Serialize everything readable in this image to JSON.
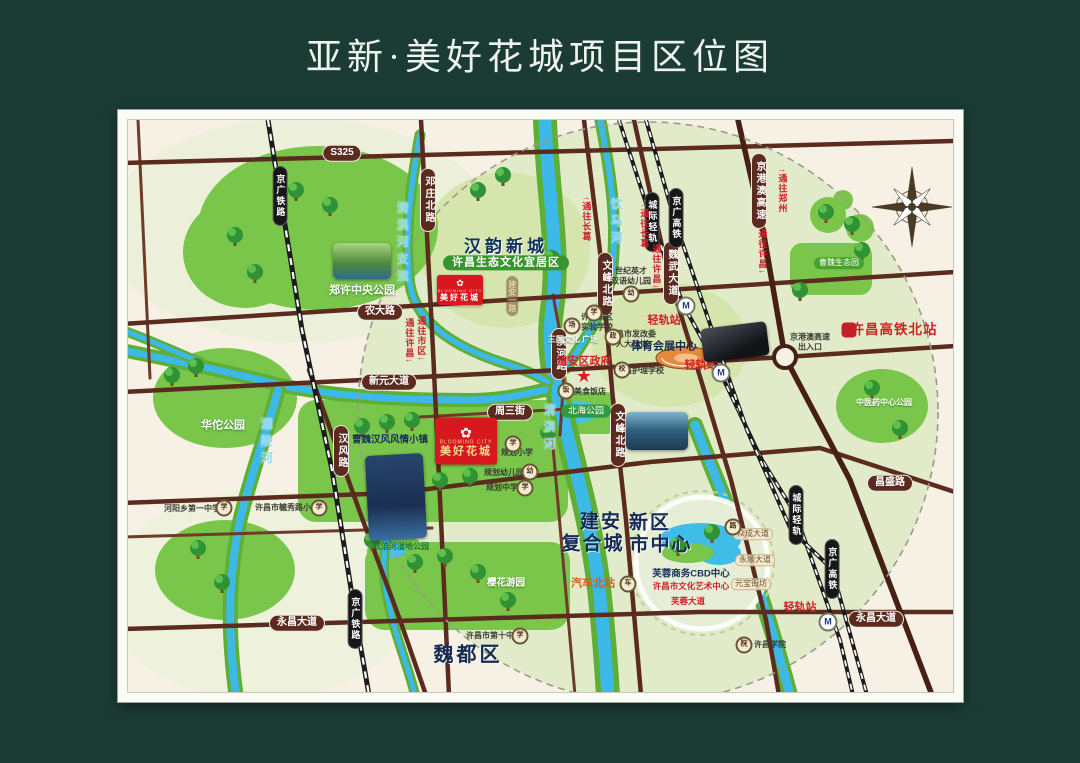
{
  "title": "亚新·美好花城项目区位图",
  "map": {
    "labels": [
      {
        "name": "road-badge-s325",
        "cls": "badge",
        "x": 342,
        "y": 153,
        "text": "S325"
      },
      {
        "name": "road-badge-nongdalu",
        "cls": "badge",
        "x": 380,
        "y": 312,
        "text": "农大路"
      },
      {
        "name": "road-badge-xinyuan-dadao",
        "cls": "badge",
        "x": 389,
        "y": 382,
        "text": "新元大道"
      },
      {
        "name": "road-badge-zhousanjie",
        "cls": "badge",
        "x": 510,
        "y": 412,
        "text": "周三街"
      },
      {
        "name": "road-badge-changsheng-w",
        "cls": "badge",
        "x": 394,
        "y": 494,
        "text": "昌盛路"
      },
      {
        "name": "road-badge-changsheng-e",
        "cls": "badge",
        "x": 890,
        "y": 483,
        "text": "昌盛路"
      },
      {
        "name": "road-badge-yongchang-w",
        "cls": "badge",
        "x": 297,
        "y": 623,
        "text": "永昌大道"
      },
      {
        "name": "road-badge-yongchang-e",
        "cls": "badge",
        "x": 876,
        "y": 619,
        "text": "永昌大道"
      },
      {
        "name": "road-badge-hanfenglu",
        "cls": "badge-v",
        "x": 341,
        "y": 451,
        "text": "汉风路"
      },
      {
        "name": "road-badge-dengzhuang-beilu",
        "cls": "badge-v",
        "x": 428,
        "y": 200,
        "text": "邓庄北路"
      },
      {
        "name": "road-badge-wenfeng-beilu-n",
        "cls": "badge-v",
        "x": 605,
        "y": 284,
        "text": "文峰北路"
      },
      {
        "name": "road-badge-wenfeng-beilu-s",
        "cls": "badge-v",
        "x": 618,
        "y": 435,
        "text": "文峰北路"
      },
      {
        "name": "road-badge-binhelu",
        "cls": "badge-v",
        "x": 559,
        "y": 354,
        "text": "滨河路"
      },
      {
        "name": "road-badge-weiwu-dadao",
        "cls": "badge-v",
        "x": 671,
        "y": 273,
        "text": "魏武大道"
      },
      {
        "name": "road-badge-jinggangao-gaosu",
        "cls": "badge-v",
        "x": 759,
        "y": 191,
        "text": "京港澳高速"
      },
      {
        "name": "road-label-jianan-yilu",
        "cls": "tan-v",
        "x": 512,
        "y": 296,
        "text": "建安一路"
      },
      {
        "name": "rail-badge-jingguang-tielu-n",
        "cls": "railbadge-v",
        "x": 280,
        "y": 196,
        "text": "京广铁路"
      },
      {
        "name": "rail-badge-jingguang-tielu-s",
        "cls": "railbadge-v",
        "x": 355,
        "y": 619,
        "text": "京广铁路"
      },
      {
        "name": "rail-badge-chengji-qinggui-n",
        "cls": "railbadge-v",
        "x": 652,
        "y": 222,
        "text": "城际轻轨"
      },
      {
        "name": "rail-badge-jingguang-gaotie-n",
        "cls": "railbadge-v",
        "x": 676,
        "y": 218,
        "text": "京广高铁"
      },
      {
        "name": "rail-badge-chengji-qinggui-s",
        "cls": "railbadge-v",
        "x": 796,
        "y": 515,
        "text": "城际轻轨"
      },
      {
        "name": "rail-badge-jingguang-gaotie-s",
        "cls": "railbadge-v",
        "x": 832,
        "y": 569,
        "text": "京广高铁"
      },
      {
        "name": "dir-label-changge-1",
        "cls": "red-v",
        "x": 586,
        "y": 219,
        "text": "↑通往长葛"
      },
      {
        "name": "dir-label-changge-2",
        "cls": "red-v",
        "x": 644,
        "y": 226,
        "text": "↑通往长葛"
      },
      {
        "name": "dir-label-xuchang-1",
        "cls": "red-v",
        "x": 656,
        "y": 267,
        "text": "通往许昌↓"
      },
      {
        "name": "dir-label-xuchang-2",
        "cls": "red-v",
        "x": 762,
        "y": 252,
        "text": "通往许昌↓"
      },
      {
        "name": "dir-label-zhengzhou",
        "cls": "red-v",
        "x": 782,
        "y": 191,
        "text": "↑通往郑州"
      },
      {
        "name": "dir-label-xuchang-3",
        "cls": "red-v",
        "x": 409,
        "y": 341,
        "text": "通往许昌↓"
      },
      {
        "name": "dir-label-shiqu",
        "cls": "red-v",
        "x": 421,
        "y": 339,
        "text": "通往市区↓"
      },
      {
        "name": "river-label-qingyihe-zhiliu",
        "cls": "cyan-v",
        "x": 402,
        "y": 244,
        "text": "清潩河支流"
      },
      {
        "name": "river-label-yinmahe",
        "cls": "cyan-v",
        "x": 616,
        "y": 223,
        "text": "饮马河"
      },
      {
        "name": "river-label-qingyihe",
        "cls": "cyan-v",
        "x": 549,
        "y": 429,
        "text": "清潩河"
      },
      {
        "name": "river-label-balinghe",
        "cls": "cyan-v",
        "x": 266,
        "y": 443,
        "text": "灞陵河"
      },
      {
        "name": "zone-title-hanyun-xincheng",
        "cls": "zone-title",
        "x": 506,
        "y": 247,
        "text": "汉韵新城"
      },
      {
        "name": "zone-pill-shengtai-wenhua",
        "cls": "zone-pill",
        "x": 506,
        "y": 263,
        "text": "许昌生态文化宜居区"
      },
      {
        "name": "park-label-zhengxu-central",
        "cls": "white-bold",
        "x": 362,
        "y": 291,
        "text": "郑许中央公园"
      },
      {
        "name": "park-label-huatuo",
        "cls": "white-bold",
        "x": 223,
        "y": 426,
        "text": "华佗公园"
      },
      {
        "name": "park-label-yinghua",
        "cls": "white-bold-sm",
        "x": 506,
        "y": 583,
        "text": "樱花游园"
      },
      {
        "name": "park-label-zhongyiyao",
        "cls": "white-xs",
        "x": 884,
        "y": 403,
        "text": "中医药中心公园"
      },
      {
        "name": "park-label-caowei-shengtaiyuan",
        "cls": "green-pill-sm",
        "x": 839,
        "y": 263,
        "text": "曹魏生态园"
      },
      {
        "name": "park-label-beihai",
        "cls": "green-pill",
        "x": 586,
        "y": 411,
        "text": "北海公园"
      },
      {
        "name": "park-label-shuangjihe-shidi",
        "cls": "green-xs",
        "x": 401,
        "y": 547,
        "text": "双洎河湿地公园"
      },
      {
        "name": "poi-label-town",
        "cls": "navy-sm-bold",
        "x": 390,
        "y": 440,
        "text": "曹魏汉风风情小镇"
      },
      {
        "name": "poi-label-planned-primary",
        "cls": "dark-xs",
        "x": 517,
        "y": 453,
        "text": "规划小学"
      },
      {
        "name": "poi-label-planned-kindergarten",
        "cls": "dark-xs",
        "x": 504,
        "y": 473,
        "text": "规划幼儿园"
      },
      {
        "name": "poi-label-planned-middle",
        "cls": "dark-xs",
        "x": 502,
        "y": 488,
        "text": "规划中学"
      },
      {
        "name": "poi-label-sanguo-square",
        "cls": "white-xs",
        "x": 573,
        "y": 340,
        "text": "三国文化\n广场"
      },
      {
        "name": "poi-label-jianan-gov",
        "cls": "red-bold",
        "x": 584,
        "y": 362,
        "text": "建安区政府"
      },
      {
        "name": "gov-star-icon",
        "cls": "star",
        "x": 584,
        "y": 376,
        "text": "★"
      },
      {
        "name": "poi-label-xinqu-school",
        "cls": "dark-xs",
        "x": 597,
        "y": 322,
        "text": "许昌新区\n实验学校"
      },
      {
        "name": "poi-label-fagaiwei",
        "cls": "dark-xs",
        "x": 632,
        "y": 339,
        "text": "许昌市发改委\n人大政协"
      },
      {
        "name": "poi-label-huli-school",
        "cls": "dark-xs",
        "x": 640,
        "y": 371,
        "text": "许昌护理学校"
      },
      {
        "name": "poi-label-restaurant",
        "cls": "dark-xs",
        "x": 582,
        "y": 392,
        "text": "东兴美食饭店"
      },
      {
        "name": "poi-label-sports-center",
        "cls": "navy-md",
        "x": 664,
        "y": 347,
        "text": "体育会展中心"
      },
      {
        "name": "station-label-qinggui-1",
        "cls": "red-bold",
        "x": 664,
        "y": 321,
        "text": "轻轨站"
      },
      {
        "name": "station-label-qinggui-2",
        "cls": "red-bold",
        "x": 701,
        "y": 366,
        "text": "轻轨站"
      },
      {
        "name": "station-label-qinggui-3",
        "cls": "red-bold",
        "x": 800,
        "y": 608,
        "text": "轻轨站"
      },
      {
        "name": "poi-label-highway-exit",
        "cls": "dark-xs",
        "x": 810,
        "y": 342,
        "text": "京港澳高速\n出入口"
      },
      {
        "name": "station-label-hsr-north",
        "cls": "red-bold-lg",
        "x": 894,
        "y": 330,
        "text": "许昌高铁北站"
      },
      {
        "name": "big-label-jianan",
        "cls": "navy-big",
        "x": 601,
        "y": 523,
        "text": "建安"
      },
      {
        "name": "big-label-xinqu",
        "cls": "navy-big",
        "x": 650,
        "y": 524,
        "text": "新区"
      },
      {
        "name": "big-label-fuhecheng",
        "cls": "navy-big",
        "x": 593,
        "y": 545,
        "text": "复合城"
      },
      {
        "name": "big-label-shizhongxin",
        "cls": "navy-big",
        "x": 661,
        "y": 546,
        "text": "市中心"
      },
      {
        "name": "big-label-weidou-district",
        "cls": "navy-big2",
        "x": 468,
        "y": 655,
        "text": "魏都区"
      },
      {
        "name": "poi-label-bus-north-station",
        "cls": "orange-bold",
        "x": 593,
        "y": 584,
        "text": "汽车北站"
      },
      {
        "name": "poi-label-furong-cbd",
        "cls": "navy-sm-bold",
        "x": 691,
        "y": 574,
        "text": "芙蓉商务CBD中心"
      },
      {
        "name": "poi-label-art-center",
        "cls": "red-xs",
        "x": 691,
        "y": 586,
        "text": "许昌市文化艺术中心"
      },
      {
        "name": "road-label-furong-dadao",
        "cls": "red-xs",
        "x": 688,
        "y": 601,
        "text": "芙蓉大道"
      },
      {
        "name": "road-label-zhongcheng-dadao",
        "cls": "tan-sm",
        "x": 753,
        "y": 534,
        "text": "众成大道"
      },
      {
        "name": "road-label-yongshun-dadao",
        "cls": "tan-sm",
        "x": 755,
        "y": 560,
        "text": "永顺大道"
      },
      {
        "name": "road-label-yuanbao-jiefang",
        "cls": "tan-sm",
        "x": 751,
        "y": 584,
        "text": "元宝街坊"
      },
      {
        "name": "poi-label-xuchang-college",
        "cls": "dark-xs",
        "x": 770,
        "y": 645,
        "text": "许昌学院"
      },
      {
        "name": "poi-label-heyang-school",
        "cls": "dark-xs",
        "x": 192,
        "y": 509,
        "text": "河阳乡第一中学"
      },
      {
        "name": "poi-label-yuxiu-school",
        "cls": "dark-xs",
        "x": 287,
        "y": 508,
        "text": "许昌市毓秀路小学"
      },
      {
        "name": "poi-label-no10-school",
        "cls": "dark-xs",
        "x": 494,
        "y": 636,
        "text": "许昌市第十中学"
      },
      {
        "name": "poi-label-kindergarten-shiji",
        "cls": "dark-xs",
        "x": 631,
        "y": 276,
        "text": "世纪英才\n双语幼儿园"
      },
      {
        "name": "poi-icon-heyang-school",
        "cls": "poi",
        "x": 224,
        "y": 508,
        "text": "学"
      },
      {
        "name": "poi-icon-yuxiu-school",
        "cls": "poi",
        "x": 319,
        "y": 508,
        "text": "学"
      },
      {
        "name": "poi-icon-no10-school",
        "cls": "poi",
        "x": 520,
        "y": 636,
        "text": "学"
      },
      {
        "name": "poi-icon-xinqu-school",
        "cls": "poi",
        "x": 594,
        "y": 313,
        "text": "学"
      },
      {
        "name": "poi-icon-fagaiwei",
        "cls": "poi",
        "x": 613,
        "y": 337,
        "text": "政"
      },
      {
        "name": "poi-icon-huli-school",
        "cls": "poi",
        "x": 622,
        "y": 370,
        "text": "校"
      },
      {
        "name": "poi-icon-restaurant",
        "cls": "poi",
        "x": 566,
        "y": 391,
        "text": "饭"
      },
      {
        "name": "poi-icon-kindergarten-shiji",
        "cls": "poi",
        "x": 631,
        "y": 294,
        "text": "幼"
      },
      {
        "name": "poi-icon-planned-primary",
        "cls": "poi",
        "x": 513,
        "y": 444,
        "text": "学"
      },
      {
        "name": "poi-icon-planned-kindergarten",
        "cls": "poi",
        "x": 530,
        "y": 472,
        "text": "幼"
      },
      {
        "name": "poi-icon-planned-middle",
        "cls": "poi",
        "x": 525,
        "y": 488,
        "text": "学"
      },
      {
        "name": "poi-icon-xuchang-college",
        "cls": "poi",
        "x": 744,
        "y": 645,
        "text": "院"
      },
      {
        "name": "poi-icon-bus-station",
        "cls": "poi",
        "x": 628,
        "y": 584,
        "text": "车"
      },
      {
        "name": "poi-icon-sanguo-square",
        "cls": "poi",
        "x": 572,
        "y": 326,
        "text": "场"
      },
      {
        "name": "poi-icon-zhongcheng",
        "cls": "poi",
        "x": 733,
        "y": 527,
        "text": "路"
      },
      {
        "name": "metro-station-icon-1",
        "cls": "station",
        "x": 686,
        "y": 306,
        "text": "M"
      },
      {
        "name": "metro-station-icon-2",
        "cls": "station",
        "x": 721,
        "y": 373,
        "text": "M"
      },
      {
        "name": "metro-station-icon-3",
        "cls": "station",
        "x": 828,
        "y": 622,
        "text": "M"
      },
      {
        "name": "china-railway-logo-icon",
        "cls": "cr-logo",
        "x": 849,
        "y": 330,
        "text": "铁"
      },
      {
        "name": "photo-central-park",
        "cls": "photo p-park",
        "x": 362,
        "y": 261,
        "w": 58,
        "h": 36
      },
      {
        "name": "photo-town",
        "cls": "photo p-town",
        "x": 396,
        "y": 497,
        "w": 58,
        "h": 85,
        "rot": -3
      },
      {
        "name": "photo-zhouzhuang",
        "cls": "photo p-zhou",
        "x": 657,
        "y": 431,
        "w": 62,
        "h": 38
      },
      {
        "name": "photo-hsr-station",
        "cls": "photo p-hsr",
        "x": 735,
        "y": 342,
        "w": 66,
        "h": 34,
        "rot": -7
      },
      {
        "name": "project-logo-main",
        "cls": "logo logo-lg",
        "x": 466,
        "y": 441,
        "flower": "✿",
        "en": "BLOOMING CITY",
        "cn": "美好花城"
      },
      {
        "name": "project-logo-north",
        "cls": "logo logo-sm",
        "x": 460,
        "y": 290,
        "flower": "✿",
        "en": "BLOOMING CITY",
        "cn": "美好花城"
      }
    ],
    "colors": {
      "background": "#1b3c34",
      "map_paper": "#f6f1e4",
      "park_green": "#79c64a",
      "water_cyan": "#3cb9e6",
      "road_maroon": "#5c2b20",
      "railway_black": "#1c1c1c",
      "brand_red": "#d8181f",
      "accent_red": "#cf2027",
      "navy_text": "#152a55"
    }
  }
}
